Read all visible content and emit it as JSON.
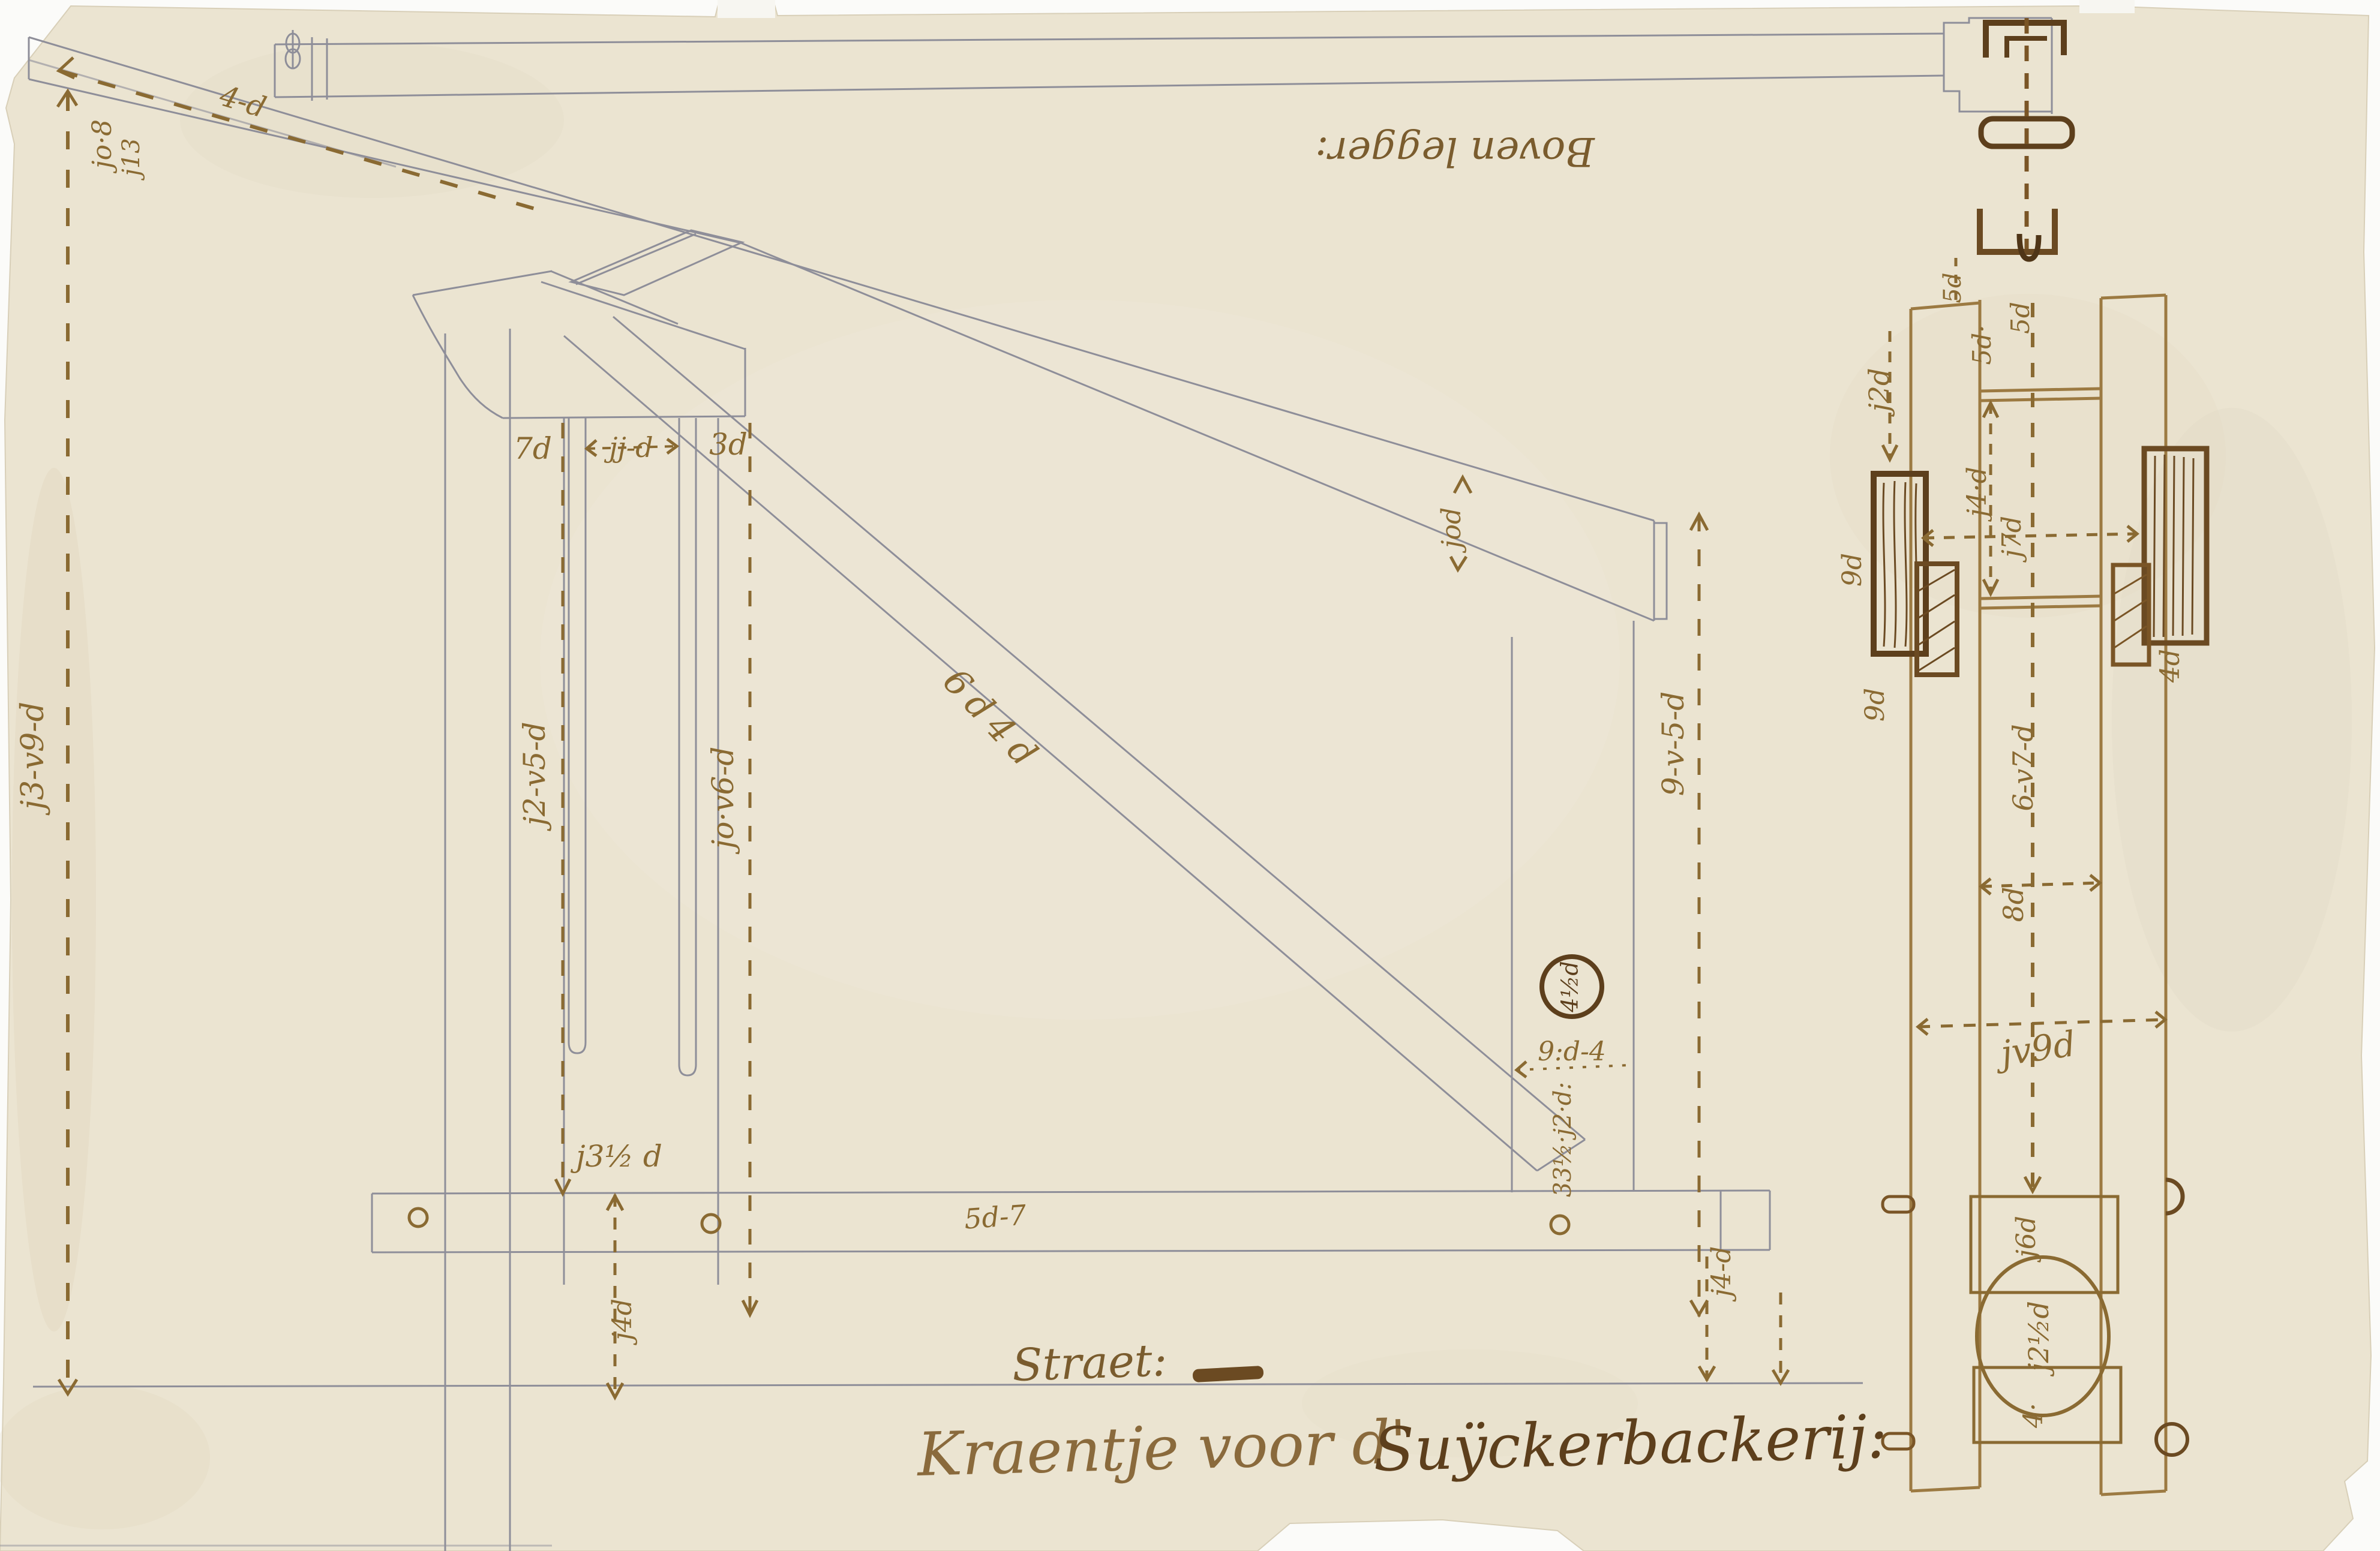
{
  "document": {
    "kind": "antique crane construction drawing",
    "caption_part1": "Kraentje voor d'",
    "caption_part2": "Suÿckerbackerij:",
    "street_label": "Straet:",
    "top_beam_label": "Boven legger:"
  },
  "colors": {
    "paper": "#ebe4d1",
    "pencil": "#8e8e99",
    "ink_light": "#8a6a32",
    "ink_mid": "#7a5526",
    "ink_dark": "#5d3f1c"
  },
  "side_view": {
    "tip_dim_a": "jo·8",
    "tip_dim_b": "j13",
    "jib_top_dim": "4-d",
    "left_height_dim": "j3-v9-d",
    "mast_left_dim": "j2-v5-d",
    "mast_right_dim": "jo·v6-d",
    "right_height_dim": "9-v-5-d",
    "cap_left_dim": "7d",
    "cap_mid_dim": "jj-d",
    "cap_right_dim": "3d",
    "brace_dim": "6d4d",
    "jib_end_dim": "jod",
    "circled_dim": "4½d",
    "post_gap_dim": "9:d-4",
    "post_stack_dim": "33½·j2·d:",
    "base_left_dim": "j3½ d",
    "base_mid_dim": "5d-7",
    "under_base_left_dim": "j4d",
    "under_base_right_dim": "j4-d"
  },
  "plan_view": {
    "left_rail_dim": "j2d",
    "top_dim_a": "5d·",
    "top_dim_b": "5d",
    "neck_dim": "5d",
    "rung_gap_dim": "j4·d",
    "width_dim": "j7d",
    "left_block_dim_a": "9d",
    "left_block_dim_b": "9d",
    "right_block_dim": "4d",
    "channel_width_dim": "8d",
    "full_width_dim": "jv9d",
    "mid_length_dim": "6-v7-d",
    "upper_block_dim": "j6d",
    "wheel_dim": "j2½d",
    "lower_block_dim": "4·"
  }
}
